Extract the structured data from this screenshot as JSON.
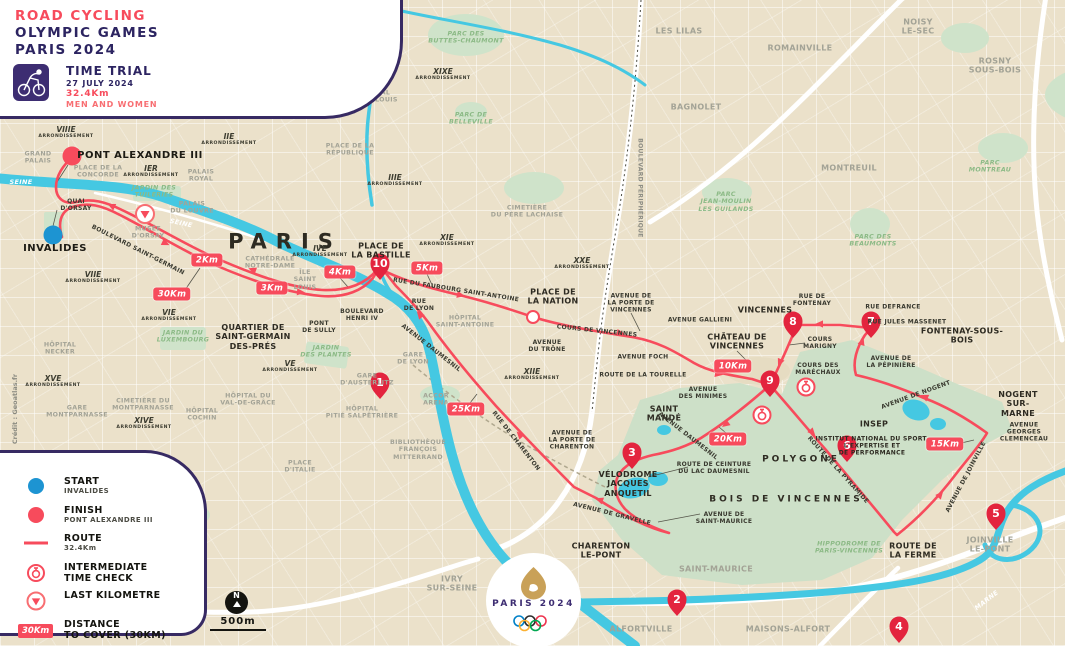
{
  "header": {
    "kicker": "ROAD CYCLING",
    "title_line1": "OLYMPIC GAMES",
    "title_line2": "PARIS 2024",
    "event": "TIME TRIAL",
    "date": "27 JULY 2024",
    "distance": "32.4Km",
    "category": "MEN AND WOMEN",
    "picto": "time-trial-cycling-pictogram"
  },
  "legend": {
    "items": [
      {
        "icon": "start-dot",
        "title": "START",
        "sub": "INVALIDES"
      },
      {
        "icon": "finish-dot",
        "title": "FINISH",
        "sub": "PONT ALEXANDRE III"
      },
      {
        "icon": "route-line",
        "title": "ROUTE",
        "sub": "32.4Km"
      },
      {
        "icon": "time-check",
        "title": "INTERMEDIATE\nTIME CHECK",
        "sub": ""
      },
      {
        "icon": "last-km",
        "title": "LAST KILOMETRE",
        "sub": ""
      },
      {
        "icon": "distance-box",
        "title": "DISTANCE\nTO COVER (30KM)",
        "sub": "",
        "badge": "30Km"
      }
    ]
  },
  "logo": {
    "wordmark": "PARIS 2024"
  },
  "scale_bar": {
    "text": "500m"
  },
  "north_label": "N",
  "credit": "Crédit : Geoatlas.fr",
  "colors": {
    "route_red": "#f74b5c",
    "pin_red": "#e3243e",
    "start_blue": "#1d94d2",
    "water": "#45c8e2",
    "park_green": "#cde0c8",
    "purple": "#372a63",
    "map_beige": "#ebe1ca"
  },
  "map": {
    "start": {
      "x": 53,
      "y": 235,
      "label": "INVALIDES"
    },
    "finish": {
      "x": 72,
      "y": 156,
      "label": "PONT ALEXANDRE III"
    },
    "km_markers": [
      {
        "t": "2Km",
        "x": 207,
        "y": 260
      },
      {
        "t": "3Km",
        "x": 272,
        "y": 288
      },
      {
        "t": "4Km",
        "x": 340,
        "y": 272
      },
      {
        "t": "5Km",
        "x": 427,
        "y": 268
      },
      {
        "t": "10Km",
        "x": 733,
        "y": 366
      },
      {
        "t": "15Km",
        "x": 945,
        "y": 444
      },
      {
        "t": "20Km",
        "x": 728,
        "y": 439
      },
      {
        "t": "25Km",
        "x": 466,
        "y": 409
      },
      {
        "t": "30Km",
        "x": 172,
        "y": 294
      }
    ],
    "pins": [
      {
        "n": "1",
        "x": 380,
        "y": 399
      },
      {
        "n": "2",
        "x": 677,
        "y": 616
      },
      {
        "n": "3",
        "x": 632,
        "y": 469
      },
      {
        "n": "4",
        "x": 899,
        "y": 643
      },
      {
        "n": "5",
        "x": 996,
        "y": 530
      },
      {
        "n": "6",
        "x": 847,
        "y": 462
      },
      {
        "n": "7",
        "x": 871,
        "y": 338
      },
      {
        "n": "8",
        "x": 793,
        "y": 338
      },
      {
        "n": "9",
        "x": 770,
        "y": 397
      },
      {
        "n": "10",
        "x": 380,
        "y": 280
      }
    ],
    "time_checks": [
      {
        "x": 806,
        "y": 387
      },
      {
        "x": 762,
        "y": 415
      }
    ],
    "last_km": {
      "x": 145,
      "y": 214
    },
    "districts": [
      {
        "n": "VIIIE",
        "x": 66,
        "y": 132
      },
      {
        "n": "IER",
        "x": 151,
        "y": 171
      },
      {
        "n": "IIE",
        "x": 229,
        "y": 139
      },
      {
        "n": "IIIE",
        "x": 395,
        "y": 180
      },
      {
        "n": "IVE",
        "x": 320,
        "y": 251
      },
      {
        "n": "VE",
        "x": 290,
        "y": 366
      },
      {
        "n": "VIE",
        "x": 169,
        "y": 315
      },
      {
        "n": "VIIE",
        "x": 93,
        "y": 277
      },
      {
        "n": "IXE",
        "x": 234,
        "y": 47
      },
      {
        "n": "XE",
        "x": 311,
        "y": 96
      },
      {
        "n": "XIE",
        "x": 447,
        "y": 240
      },
      {
        "n": "XIIE",
        "x": 532,
        "y": 374
      },
      {
        "n": "XIVE",
        "x": 144,
        "y": 423
      },
      {
        "n": "XVE",
        "x": 53,
        "y": 381
      },
      {
        "n": "XIXE",
        "x": 443,
        "y": 74
      },
      {
        "n": "XXE",
        "x": 582,
        "y": 263
      }
    ],
    "district_word": "ARRONDISSEMENT",
    "labels": [
      {
        "t": "PARIS",
        "x": 285,
        "y": 242,
        "c": "metro"
      },
      {
        "t": "VINCENNES",
        "x": 765,
        "y": 310,
        "c": "city"
      },
      {
        "t": "SAINT\nMANDÉ",
        "x": 664,
        "y": 414,
        "c": "city"
      },
      {
        "t": "CHARENTON\nLE-PONT",
        "x": 601,
        "y": 551,
        "c": "city"
      },
      {
        "t": "NOGENT\nSUR-MARNE",
        "x": 1018,
        "y": 404,
        "c": "city"
      },
      {
        "t": "FONTENAY-SOUS-BOIS",
        "x": 962,
        "y": 336,
        "c": "city"
      },
      {
        "t": "CHÂTEAU DE\nVINCENNES",
        "x": 737,
        "y": 342,
        "c": "city"
      },
      {
        "t": "PLACE DE\nLA BASTILLE",
        "x": 381,
        "y": 251,
        "c": "city"
      },
      {
        "t": "PLACE DE\nLA NATION",
        "x": 553,
        "y": 297,
        "c": "city"
      },
      {
        "t": "INSEP",
        "x": 874,
        "y": 424,
        "c": "city"
      },
      {
        "t": "INSTITUT NATIONAL DU SPORT,\nL'EXPERTISE ET\nDE PERFORMANCE",
        "x": 872,
        "y": 446,
        "c": "ins"
      },
      {
        "t": "POLYGONE",
        "x": 801,
        "y": 460,
        "c": "cityw"
      },
      {
        "t": "BOIS DE VINCENNES",
        "x": 786,
        "y": 500,
        "c": "cityw"
      },
      {
        "t": "VÉLODROME\nJACQUES\nANQUETIL",
        "x": 628,
        "y": 484,
        "c": "city"
      },
      {
        "t": "QUARTIER DE\nSAINT-GERMAIN\nDES-PRÉS",
        "x": 253,
        "y": 337,
        "c": "city"
      },
      {
        "t": "INVALIDES",
        "x": 55,
        "y": 249,
        "c": "citybig"
      },
      {
        "t": "PONT ALEXANDRE III",
        "x": 140,
        "y": 156,
        "c": "citybig"
      },
      {
        "t": "ROUTE DE\nLA FERME",
        "x": 913,
        "y": 551,
        "c": "city"
      },
      {
        "t": "LES LILAS",
        "x": 679,
        "y": 31,
        "c": "town"
      },
      {
        "t": "ROMAINVILLE",
        "x": 800,
        "y": 48,
        "c": "town"
      },
      {
        "t": "NOISY\nLE-SEC",
        "x": 918,
        "y": 27,
        "c": "town"
      },
      {
        "t": "ROSNY\nSOUS-BOIS",
        "x": 995,
        "y": 66,
        "c": "town"
      },
      {
        "t": "BAGNOLET",
        "x": 696,
        "y": 107,
        "c": "town"
      },
      {
        "t": "MONTREUIL",
        "x": 849,
        "y": 168,
        "c": "town"
      },
      {
        "t": "SAINT-MAURICE",
        "x": 716,
        "y": 569,
        "c": "town"
      },
      {
        "t": "ALFORTVILLE",
        "x": 641,
        "y": 629,
        "c": "town"
      },
      {
        "t": "MAISONS-ALFORT",
        "x": 788,
        "y": 629,
        "c": "town"
      },
      {
        "t": "IVRY\nSUR-SEINE",
        "x": 452,
        "y": 584,
        "c": "town"
      },
      {
        "t": "JOINVILLE\nLE-PONT",
        "x": 990,
        "y": 545,
        "c": "town"
      },
      {
        "t": "GRAND\nPALAIS",
        "x": 38,
        "y": 158,
        "c": "poi"
      },
      {
        "t": "PLACE DE LA\nCONCORDE",
        "x": 98,
        "y": 172,
        "c": "poi"
      },
      {
        "t": "PALAIS\nROYAL",
        "x": 201,
        "y": 176,
        "c": "poi"
      },
      {
        "t": "PALAIS\nDU LOUVRE",
        "x": 192,
        "y": 208,
        "c": "poi"
      },
      {
        "t": "MUSÉE\nD'ORSAY",
        "x": 148,
        "y": 233,
        "c": "poi"
      },
      {
        "t": "CATHÉDRALE\nNOTRE-DAME",
        "x": 270,
        "y": 263,
        "c": "poi"
      },
      {
        "t": "ÎLE\nSAINT\nLOUIS",
        "x": 305,
        "y": 280,
        "c": "poi"
      },
      {
        "t": "HÔPITAL\nSAINT-LOUIS",
        "x": 374,
        "y": 97,
        "c": "poi"
      },
      {
        "t": "GARE\nDU NORD",
        "x": 298,
        "y": 35,
        "c": "poi"
      },
      {
        "t": "GARE\nDE L'EST",
        "x": 325,
        "y": 64,
        "c": "poi"
      },
      {
        "t": "PLACE DE LA\nRÉPUBLIQUE",
        "x": 350,
        "y": 150,
        "c": "poi"
      },
      {
        "t": "CIMETIÈRE\nDU PÈRE LACHAISE",
        "x": 527,
        "y": 212,
        "c": "poi"
      },
      {
        "t": "HÔPITAL\nSAINT-ANTOINE",
        "x": 465,
        "y": 322,
        "c": "poi"
      },
      {
        "t": "GARE\nDE LYON",
        "x": 413,
        "y": 359,
        "c": "poi"
      },
      {
        "t": "ACCOR\nARENA",
        "x": 436,
        "y": 400,
        "c": "poi"
      },
      {
        "t": "GARE\nD'AUSTERLITZ",
        "x": 367,
        "y": 380,
        "c": "poi"
      },
      {
        "t": "HÔPITAL\nPITIÉ SALPÊTRIÈRE",
        "x": 362,
        "y": 413,
        "c": "poi"
      },
      {
        "t": "HÔPITAL DU\nVAL-DE-GRÂCE",
        "x": 248,
        "y": 400,
        "c": "poi"
      },
      {
        "t": "HÔPITAL\nCOCHIN",
        "x": 202,
        "y": 415,
        "c": "poi"
      },
      {
        "t": "CIMETIÈRE DU\nMONTPARNASSE",
        "x": 143,
        "y": 405,
        "c": "poi"
      },
      {
        "t": "GARE\nMONTPARNASSE",
        "x": 77,
        "y": 412,
        "c": "poi"
      },
      {
        "t": "HÔPITAL\nNECKER",
        "x": 60,
        "y": 349,
        "c": "poi"
      },
      {
        "t": "BIBLIOTHÈQUE\nFRANÇOIS\nMITTERRAND",
        "x": 418,
        "y": 450,
        "c": "poi"
      },
      {
        "t": "PLACE\nD'ITALIE",
        "x": 300,
        "y": 467,
        "c": "poi"
      },
      {
        "t": "JARDIN DES\nTUILERIES",
        "x": 154,
        "y": 192,
        "c": "park"
      },
      {
        "t": "JARDIN DU\nLUXEMBOURG",
        "x": 183,
        "y": 337,
        "c": "park"
      },
      {
        "t": "JARDIN\nDES PLANTES",
        "x": 326,
        "y": 352,
        "c": "park"
      },
      {
        "t": "PARC DES\nBUTTES-CHAUMONT",
        "x": 466,
        "y": 38,
        "c": "park"
      },
      {
        "t": "PARC DE\nBELLEVILLE",
        "x": 471,
        "y": 119,
        "c": "park"
      },
      {
        "t": "PARC\nJEAN-MOULIN\nLES GUILANDS",
        "x": 726,
        "y": 202,
        "c": "park"
      },
      {
        "t": "PARC\nMONTREAU",
        "x": 990,
        "y": 167,
        "c": "park"
      },
      {
        "t": "PARC DES\nBEAUMONTS",
        "x": 873,
        "y": 241,
        "c": "park"
      },
      {
        "t": "HIPPODROME DE\nPARIS-VINCENNES",
        "x": 849,
        "y": 548,
        "c": "park"
      },
      {
        "t": "SEINE",
        "x": 21,
        "y": 183,
        "c": "water"
      },
      {
        "t": "SEINE",
        "x": 181,
        "y": 224,
        "c": "water",
        "r": 12
      },
      {
        "t": "MARNE",
        "x": 987,
        "y": 601,
        "c": "water",
        "r": -38
      },
      {
        "t": "QUAI\nD'ORSAY",
        "x": 76,
        "y": 205,
        "c": "street"
      },
      {
        "t": "BOULEVARD SAINT-GERMAIN",
        "x": 138,
        "y": 250,
        "c": "street",
        "r": 27
      },
      {
        "t": "RUE DU FAUBOURG SAINT-ANTOINE",
        "x": 456,
        "y": 290,
        "c": "street",
        "r": 9
      },
      {
        "t": "RUE\nDE LYON",
        "x": 419,
        "y": 305,
        "c": "street"
      },
      {
        "t": "BOULEVARD\nHENRI IV",
        "x": 362,
        "y": 315,
        "c": "street"
      },
      {
        "t": "PONT\nDE SULLY",
        "x": 319,
        "y": 327,
        "c": "street"
      },
      {
        "t": "COURS DE VINCENNES",
        "x": 597,
        "y": 331,
        "c": "street",
        "r": 6
      },
      {
        "t": "AVENUE DE\nLA PORTE DE\nVINCENNES",
        "x": 631,
        "y": 303,
        "c": "street"
      },
      {
        "t": "AVENUE GALLIENI",
        "x": 700,
        "y": 320,
        "c": "street"
      },
      {
        "t": "RUE DE\nFONTENAY",
        "x": 812,
        "y": 300,
        "c": "street"
      },
      {
        "t": "RUE DEFRANCE",
        "x": 893,
        "y": 307,
        "c": "street"
      },
      {
        "t": "RUE JULES MASSENET",
        "x": 907,
        "y": 322,
        "c": "street"
      },
      {
        "t": "AVENUE FOCH",
        "x": 643,
        "y": 357,
        "c": "street"
      },
      {
        "t": "ROUTE DE LA TOURELLE",
        "x": 643,
        "y": 375,
        "c": "street"
      },
      {
        "t": "COURS\nMARIGNY",
        "x": 820,
        "y": 343,
        "c": "street"
      },
      {
        "t": "COURS DES\nMARÉCHAUX",
        "x": 818,
        "y": 369,
        "c": "street"
      },
      {
        "t": "AVENUE DE\nLA PÉPINIÈRE",
        "x": 891,
        "y": 362,
        "c": "street"
      },
      {
        "t": "AVENUE DE NOGENT",
        "x": 916,
        "y": 395,
        "c": "street",
        "r": -20
      },
      {
        "t": "AVENUE\nDES MINIMES",
        "x": 703,
        "y": 393,
        "c": "street"
      },
      {
        "t": "AVENUE DAUMESNIL",
        "x": 688,
        "y": 436,
        "c": "street",
        "r": 38
      },
      {
        "t": "AVENUE DAUMESNIL",
        "x": 431,
        "y": 348,
        "c": "street",
        "r": 38
      },
      {
        "t": "ROUTE DE CEINTURE\nDU LAC DAUMESNIL",
        "x": 714,
        "y": 468,
        "c": "street"
      },
      {
        "t": "AVENUE DE\nSAINT-MAURICE",
        "x": 724,
        "y": 518,
        "c": "street"
      },
      {
        "t": "AVENUE DE GRAVELLE",
        "x": 612,
        "y": 514,
        "c": "street",
        "r": 14
      },
      {
        "t": "RUE DE CHARENTON",
        "x": 516,
        "y": 441,
        "c": "street",
        "r": 52
      },
      {
        "t": "AVENUE DE\nLA PORTE DE\nCHARENTON",
        "x": 572,
        "y": 440,
        "c": "street"
      },
      {
        "t": "AVENUE\nDU TRÔNE",
        "x": 547,
        "y": 346,
        "c": "street"
      },
      {
        "t": "AVENUE DE JOINVILLE",
        "x": 966,
        "y": 477,
        "c": "street",
        "r": -62
      },
      {
        "t": "AVENUE\nGEORGES\nCLEMENCEAU",
        "x": 1024,
        "y": 432,
        "c": "street"
      },
      {
        "t": "ROUTE DE LA PYRAMIDE",
        "x": 838,
        "y": 470,
        "c": "street",
        "r": 48
      },
      {
        "t": "BOULEVARD PÉRIPHÉRIQUE",
        "x": 640,
        "y": 188,
        "c": "stgrey",
        "r": 90
      }
    ]
  }
}
